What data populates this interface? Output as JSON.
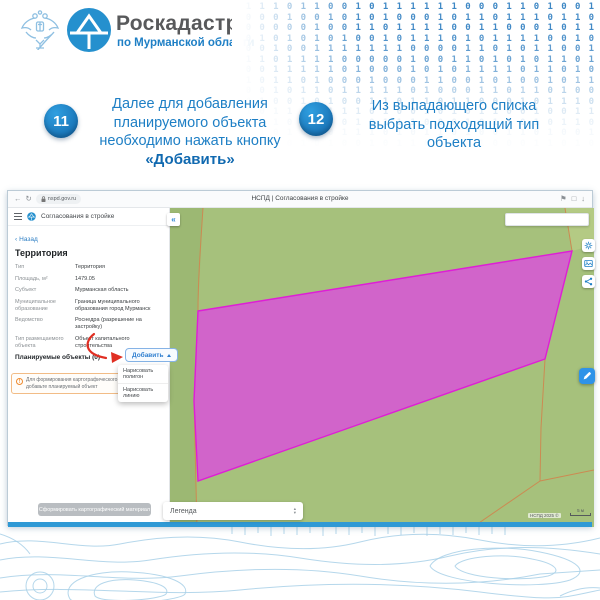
{
  "header": {
    "brand_name": "Роскадастр",
    "brand_region": "по Мурманской области"
  },
  "decor": {
    "binary_rows": [
      "011101100101111110001101001",
      "100010010101000101101110110",
      "000000100110111100110001011",
      "101010101001011101011110010",
      "000100111111100001101011001",
      "011011110000010011010101101",
      "100111110100010101111011010",
      "110110100010001100101001011",
      "000101101111101000110110100",
      "101001010011011011000101110",
      "010110011101001010110010011",
      "100100110101110001011010110",
      "011010001110101101001101001",
      "101101010010110110100011010"
    ]
  },
  "steps": [
    {
      "number": "11",
      "lines": [
        "Далее для добавления",
        "планируемого объекта",
        "необходимо нажать кнопку"
      ],
      "bold_line": "«Добавить»"
    },
    {
      "number": "12",
      "lines": [
        "Из выпадающего списка",
        "выбрать подходящий тип",
        "объекта"
      ],
      "bold_line": ""
    }
  ],
  "browser": {
    "url": "nspd.gov.ru",
    "tab_title": "НСПД | Согласования в стройке"
  },
  "app": {
    "title": "Согласования в стройке",
    "back_label": "Назад",
    "panel": {
      "heading": "Территория",
      "rows": [
        {
          "label": "Тип",
          "value": "Территория"
        },
        {
          "label": "Площадь, м²",
          "value": "1479.05"
        },
        {
          "label": "Субъект",
          "value": "Мурманская область"
        },
        {
          "label": "Муниципальное образование",
          "value": "Граница муниципального образования город Мурманск"
        },
        {
          "label": "Ведомство",
          "value": "Роснедра (разрешение на застройку)"
        },
        {
          "label": "Тип размещаемого объекта",
          "value": "Объект капитального строительства"
        }
      ],
      "planned_objects_label": "Планируемые объекты (0)",
      "add_button_label": "Добавить",
      "dropdown_items": [
        "Нарисовать полигон",
        "Нарисовать линию"
      ],
      "warning_text": "Для формирования картографического материала добавьте планируемый объект",
      "generate_button_label": "Сформировать картографический материал"
    },
    "map": {
      "legend_label": "Легенда",
      "attribution": "НСПД 2025 ©",
      "scale_label": "5 м"
    }
  },
  "icons": {
    "back_arrow": "←",
    "reload": "↻",
    "bookmark": "⚑",
    "window": "□",
    "download": "↓",
    "collapse_left": "«",
    "back_chevron": "‹",
    "sort_up": "▴",
    "sort_down": "▾",
    "warning_mark": "!"
  },
  "colors": {
    "accent_blue": "#1e7fc5",
    "brand_gray": "#58595b",
    "circle_blue": "#1164a8",
    "binary_blue": "#2d7dc0",
    "map_green": "#a6c17c",
    "map_green_dark": "#9cb873",
    "map_green_light": "#b4ca84",
    "magenta_fill": "#d55cd0",
    "magenta_stroke": "#de1ed6",
    "boundary_orange": "#cc8a52",
    "warning_orange": "#ef8b2f",
    "arrow_red": "#e02f23",
    "link_blue": "#2e7fc4",
    "footer_blue": "#2f99d5",
    "contour_blue": "#a8d0e8"
  }
}
